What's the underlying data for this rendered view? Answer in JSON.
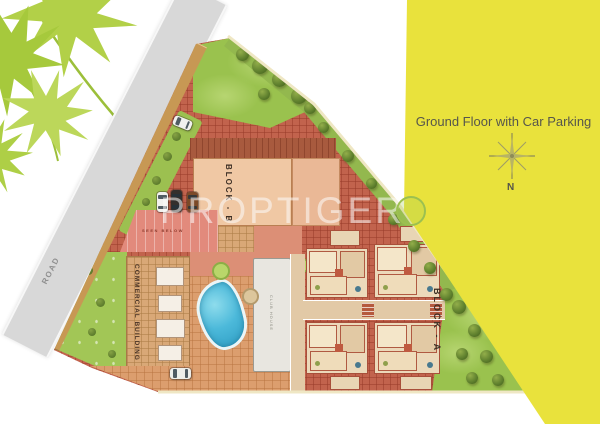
{
  "header": {
    "title": "Ground Floor with Car Parking",
    "compass": "N"
  },
  "watermark": "PROPTIGER",
  "plan": {
    "road": "ROAD",
    "block_a": "BLOCK - A",
    "block_b": "BLOCK - B",
    "commercial": "COMMERCIAL BUILDING",
    "parking_note": "SEEN BELOW",
    "club_house": "CLUB HOUSE"
  },
  "colors": {
    "panel_yellow": "#e9e23c",
    "paving_red": "#c2634d",
    "plaza_tan": "#dc9e6e",
    "lawn_green": "#a2c656",
    "pool_blue": "#45b6d8",
    "road_gray": "#d8d8d8"
  }
}
